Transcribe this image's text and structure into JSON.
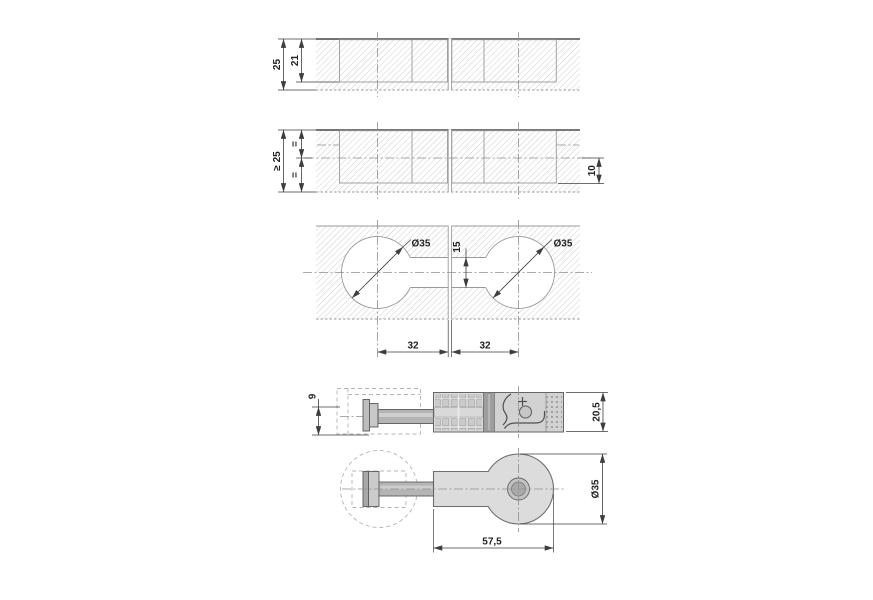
{
  "colors": {
    "bg": "#ffffff",
    "line": "#4f4f4f",
    "gray": "#9a9a9a",
    "hatch": "#c9c9c9",
    "center": "#8f8f8f",
    "dim": "#3e3e3e",
    "text": "#222222",
    "phantom": "#b4b4b4",
    "fill-light": "#dcdcdc",
    "fill-mid": "#bdbdbd",
    "fill-dark": "#9e9e9e"
  },
  "views": {
    "panel_section_25": {
      "thickness": "25",
      "pocket_depth": "21"
    },
    "panel_section_min25": {
      "thickness": "≥ 25",
      "equal_top": "=",
      "equal_bottom": "=",
      "bottom_offset": "10"
    },
    "drilling_pattern": {
      "bore_dia_left": "Ø35",
      "bore_dia_right": "Ø35",
      "channel_width": "15",
      "spacing_left": "32",
      "spacing_right": "32"
    },
    "fitting_side": {
      "head_dim": "9",
      "body_height": "20,5"
    },
    "fitting_plan": {
      "disc_dia": "Ø35",
      "overall_length": "57,5"
    }
  }
}
